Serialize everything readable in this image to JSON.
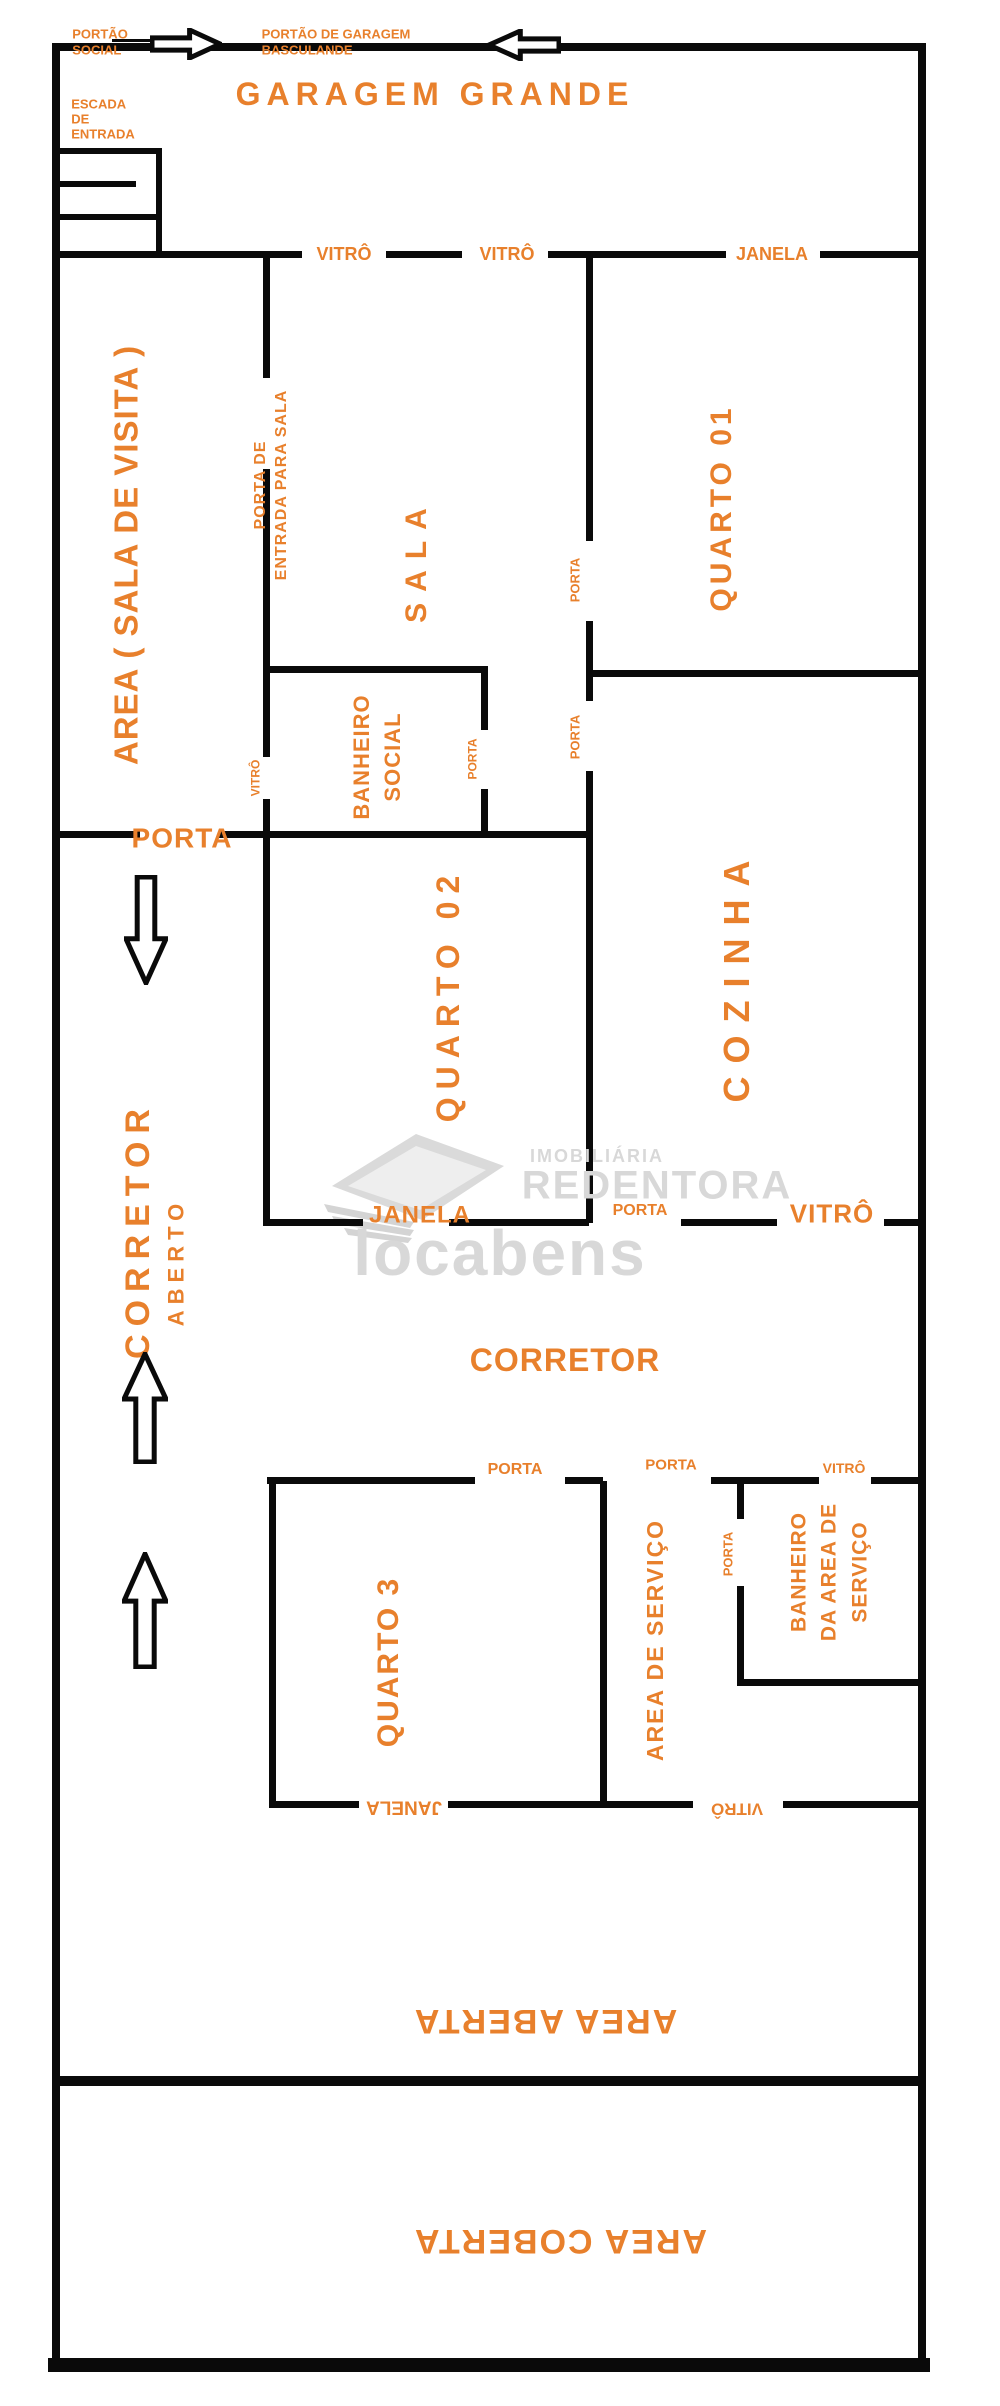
{
  "page": {
    "title": "Planta baixa de imóvel residencial",
    "background": "#ffffff",
    "wall_color": "#0a0a0a",
    "accent_color": "#e8802c",
    "watermark_color": "#d8d8d8",
    "width": 1000,
    "height": 2406
  },
  "rooms": [
    "GARAGEM GRANDE",
    "AREA ( SALA DE VISITA )",
    "SALA",
    "QUARTO 01",
    "BANHEIRO SOCIAL",
    "QUARTO 02",
    "COZINHA",
    "CORRETOR ABERTO",
    "CORRETOR",
    "QUARTO 3",
    "AREA DE SERVIÇO",
    "BANHEIRO DA AREA DE SERVIÇO",
    "AREA ABERTA",
    "AREA COBERTA"
  ],
  "walls": [
    [
      52,
      43,
      8,
      2327
    ],
    [
      52,
      43,
      868,
      8
    ],
    [
      918,
      43,
      8,
      2327
    ],
    [
      48,
      2358,
      882,
      14
    ],
    [
      112,
      39,
      38,
      3
    ],
    [
      56,
      148,
      106,
      6
    ],
    [
      156,
      148,
      6,
      109
    ],
    [
      56,
      181,
      80,
      6
    ],
    [
      56,
      214,
      100,
      6
    ],
    [
      52,
      251,
      250,
      7
    ],
    [
      386,
      251,
      76,
      7
    ],
    [
      548,
      251,
      178,
      7
    ],
    [
      820,
      251,
      100,
      7
    ],
    [
      586,
      251,
      7,
      290
    ],
    [
      586,
      621,
      7,
      80
    ],
    [
      586,
      771,
      7,
      452
    ],
    [
      593,
      670,
      327,
      7
    ],
    [
      263,
      251,
      7,
      127
    ],
    [
      263,
      469,
      7,
      288
    ],
    [
      263,
      799,
      7,
      39
    ],
    [
      266,
      666,
      222,
      7
    ],
    [
      481,
      666,
      7,
      64
    ],
    [
      481,
      789,
      7,
      49
    ],
    [
      52,
      831,
      88,
      7
    ],
    [
      218,
      831,
      372,
      7
    ],
    [
      263,
      838,
      7,
      388
    ],
    [
      263,
      1219,
      100,
      7
    ],
    [
      449,
      1219,
      140,
      7
    ],
    [
      681,
      1219,
      96,
      7
    ],
    [
      884,
      1219,
      36,
      7
    ],
    [
      267,
      1477,
      208,
      7
    ],
    [
      565,
      1477,
      38,
      7
    ],
    [
      711,
      1477,
      108,
      7
    ],
    [
      871,
      1477,
      49,
      7
    ],
    [
      269,
      1477,
      7,
      331
    ],
    [
      600,
      1481,
      7,
      327
    ],
    [
      737,
      1481,
      7,
      38
    ],
    [
      737,
      1586,
      7,
      100
    ],
    [
      737,
      1679,
      185,
      7
    ],
    [
      269,
      1801,
      90,
      7
    ],
    [
      448,
      1801,
      245,
      7
    ],
    [
      783,
      1801,
      137,
      7
    ],
    [
      52,
      2076,
      868,
      10
    ]
  ],
  "labels": [
    {
      "name": "label-portao-social",
      "text": "PORTÃO\nSOCIAL",
      "x": 100,
      "y": 42,
      "fs": 13,
      "rot": 0,
      "ls": 0,
      "lh": 1.2,
      "align": "left"
    },
    {
      "name": "label-portao-garagem-basculande",
      "text": "PORTÃO DE GARAGEM\nBASCULANDE",
      "x": 336,
      "y": 42,
      "fs": 13,
      "rot": 0,
      "ls": 0,
      "lh": 1.2,
      "align": "left"
    },
    {
      "name": "label-escada-de-entrada",
      "text": "ESCADA\nDE\nENTRADA",
      "x": 103,
      "y": 120,
      "fs": 13,
      "rot": 0,
      "ls": 0,
      "lh": 1.15,
      "align": "left"
    },
    {
      "name": "label-garagem-grande",
      "text": "GARAGEM GRANDE",
      "x": 435,
      "y": 95,
      "fs": 32,
      "rot": 0,
      "ls": 6
    },
    {
      "name": "label-vitro-garagem-1",
      "text": "VITRÔ",
      "x": 344,
      "y": 254,
      "fs": 18,
      "rot": 0,
      "ls": 0
    },
    {
      "name": "label-vitro-garagem-2",
      "text": "VITRÔ",
      "x": 507,
      "y": 254,
      "fs": 18,
      "rot": 0,
      "ls": 0
    },
    {
      "name": "label-janela-quarto01",
      "text": "JANELA",
      "x": 772,
      "y": 254,
      "fs": 18,
      "rot": 0,
      "ls": 0
    },
    {
      "name": "label-area-sala-de-visita",
      "text": "AREA ( SALA DE VISITA )",
      "x": 127,
      "y": 555,
      "fs": 33,
      "rot": -90,
      "ls": 1
    },
    {
      "name": "label-porta-entrada-para-sala",
      "text": "PORTA DE\nENTRADA PARA SALA",
      "x": 272,
      "y": 485,
      "fs": 16,
      "rot": -90,
      "ls": 1,
      "lh": 1.3,
      "align": "center"
    },
    {
      "name": "label-sala",
      "text": "SALA",
      "x": 417,
      "y": 560,
      "fs": 30,
      "rot": -90,
      "ls": 11
    },
    {
      "name": "label-quarto-01",
      "text": "QUARTO 01",
      "x": 722,
      "y": 508,
      "fs": 30,
      "rot": -90,
      "ls": 4
    },
    {
      "name": "label-porta-sala-quarto01",
      "text": "PORTA",
      "x": 576,
      "y": 580,
      "fs": 13,
      "rot": -90,
      "ls": 0
    },
    {
      "name": "label-porta-hall-cozinha",
      "text": "PORTA",
      "x": 576,
      "y": 737,
      "fs": 13,
      "rot": -90,
      "ls": 0
    },
    {
      "name": "label-vitro-banheiro-social",
      "text": "VITRÔ",
      "x": 256,
      "y": 778,
      "fs": 12,
      "rot": -90,
      "ls": 0
    },
    {
      "name": "label-banheiro-social",
      "text": "BANHEIRO\nSOCIAL",
      "x": 378,
      "y": 757,
      "fs": 22,
      "rot": -90,
      "ls": 1,
      "lh": 1.4
    },
    {
      "name": "label-porta-banheiro-social",
      "text": "PORTA",
      "x": 473,
      "y": 759,
      "fs": 12,
      "rot": -90,
      "ls": 0
    },
    {
      "name": "label-porta-area-corredor",
      "text": "PORTA",
      "x": 182,
      "y": 838,
      "fs": 28,
      "rot": 0,
      "ls": 1
    },
    {
      "name": "label-quarto-02",
      "text": "QUARTO 02",
      "x": 449,
      "y": 995,
      "fs": 32,
      "rot": -90,
      "ls": 8
    },
    {
      "name": "label-cozinha",
      "text": "COZINHA",
      "x": 737,
      "y": 975,
      "fs": 36,
      "rot": -90,
      "ls": 13
    },
    {
      "name": "label-corretor-aberto",
      "text": "CORRETOR",
      "x": 138,
      "y": 1230,
      "fs": 34,
      "rot": -90,
      "ls": 8
    },
    {
      "name": "label-aberto",
      "text": "ABERTO",
      "x": 177,
      "y": 1262,
      "fs": 22,
      "rot": -90,
      "ls": 6
    },
    {
      "name": "label-janela-quarto02",
      "text": "JANELA",
      "x": 420,
      "y": 1216,
      "fs": 24,
      "rot": 0,
      "ls": 1
    },
    {
      "name": "label-porta-cozinha",
      "text": "PORTA",
      "x": 640,
      "y": 1211,
      "fs": 16,
      "rot": 0,
      "ls": 0
    },
    {
      "name": "label-vitro-cozinha",
      "text": "VITRÔ",
      "x": 832,
      "y": 1214,
      "fs": 26,
      "rot": 0,
      "ls": 1
    },
    {
      "name": "label-corretor",
      "text": "CORRETOR",
      "x": 565,
      "y": 1361,
      "fs": 32,
      "rot": 0,
      "ls": 1
    },
    {
      "name": "label-porta-quarto3",
      "text": "PORTA",
      "x": 515,
      "y": 1470,
      "fs": 16,
      "rot": 0,
      "ls": 0
    },
    {
      "name": "label-porta-area-servico",
      "text": "PORTA",
      "x": 671,
      "y": 1466,
      "fs": 15,
      "rot": 0,
      "ls": 0
    },
    {
      "name": "label-vitro-banheiro-servico",
      "text": "VITRÔ",
      "x": 844,
      "y": 1469,
      "fs": 14,
      "rot": 0,
      "ls": 0
    },
    {
      "name": "label-quarto-3",
      "text": "QUARTO 3",
      "x": 389,
      "y": 1662,
      "fs": 30,
      "rot": -90,
      "ls": 2
    },
    {
      "name": "label-porta-banheiro-servico",
      "text": "PORTA",
      "x": 729,
      "y": 1554,
      "fs": 13,
      "rot": -90,
      "ls": 0
    },
    {
      "name": "label-area-de-servico",
      "text": "AREA DE SERVIÇO",
      "x": 656,
      "y": 1640,
      "fs": 23,
      "rot": -90,
      "ls": 2
    },
    {
      "name": "label-banheiro-area-servico",
      "text": "BANHEIRO\nDA AREA DE\nSERVIÇO",
      "x": 830,
      "y": 1572,
      "fs": 21,
      "rot": -90,
      "ls": 1,
      "lh": 1.45
    },
    {
      "name": "label-janela-quarto3",
      "text": "JANELA",
      "x": 404,
      "y": 1807,
      "fs": 19,
      "rot": 180,
      "ls": 0
    },
    {
      "name": "label-vitro-area-servico",
      "text": "VITRÔ",
      "x": 737,
      "y": 1809,
      "fs": 17,
      "rot": 180,
      "ls": 0
    },
    {
      "name": "label-area-aberta",
      "text": "AREA ABERTA",
      "x": 545,
      "y": 2021,
      "fs": 34,
      "rot": 180,
      "ls": 2
    },
    {
      "name": "label-area-coberta",
      "text": "AREA COBERTA",
      "x": 560,
      "y": 2241,
      "fs": 34,
      "rot": 180,
      "ls": 2
    },
    {
      "name": "watermark-imobiliaria",
      "text": "IMOBILIÁRIA",
      "x": 597,
      "y": 1156,
      "fs": 18,
      "rot": 0,
      "ls": 2,
      "wm": true
    },
    {
      "name": "watermark-redentora",
      "text": "REDENTORA",
      "x": 657,
      "y": 1186,
      "fs": 40,
      "rot": 0,
      "ls": 2,
      "wm": true
    },
    {
      "name": "watermark-locabens",
      "text": "locabens",
      "x": 500,
      "y": 1254,
      "fs": 64,
      "rot": 0,
      "ls": 2,
      "wm": true
    }
  ],
  "arrows": [
    {
      "name": "arrow-right-icon",
      "x": 150,
      "y": 28,
      "w": 72,
      "h": 32,
      "dir": "right"
    },
    {
      "name": "arrow-left-icon",
      "x": 487,
      "y": 29,
      "w": 74,
      "h": 32,
      "dir": "left"
    },
    {
      "name": "arrow-down-icon",
      "x": 124,
      "y": 875,
      "w": 44,
      "h": 110,
      "dir": "down"
    },
    {
      "name": "arrow-up-icon-1",
      "x": 122,
      "y": 1352,
      "w": 46,
      "h": 112,
      "dir": "up"
    },
    {
      "name": "arrow-up-icon-2",
      "x": 122,
      "y": 1552,
      "w": 46,
      "h": 117,
      "dir": "up"
    }
  ]
}
